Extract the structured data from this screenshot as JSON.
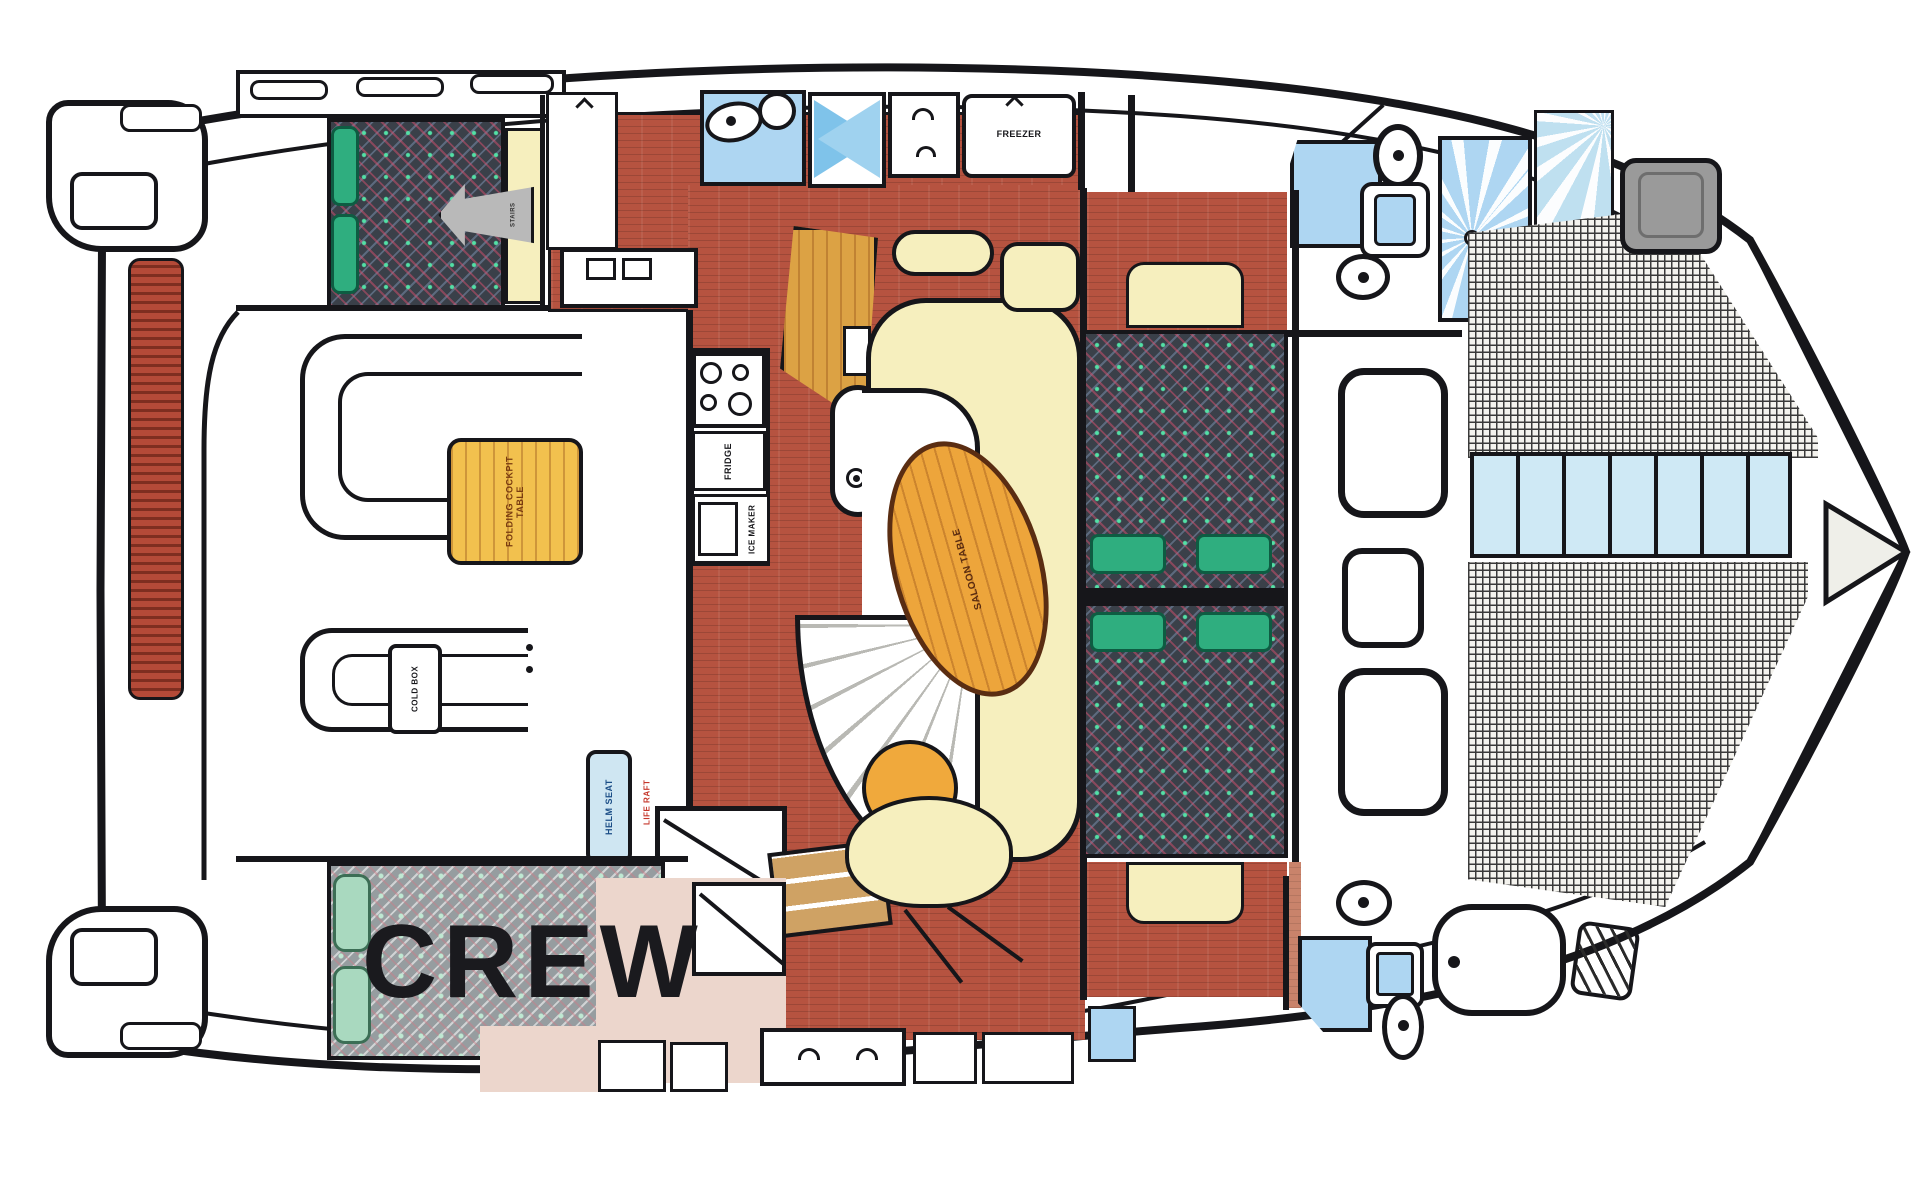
{
  "diagram_title": "Catamaran interior layout floor plan",
  "labels": {
    "crew": "CREW",
    "freezer": "FREEZER",
    "fridge": "FRIDGE",
    "ice_maker": "ICE MAKER",
    "cold_box": "COLD BOX",
    "helm_seat": "HELM SEAT",
    "life_raft": "LIFE RAFT",
    "folding_cockpit_table": "FOLDING COCKPIT TABLE",
    "saloon_table": "SALOON TABLE",
    "stairs": "STAIRS"
  },
  "colors": {
    "hull_outline": "#16161a",
    "wood_floor": "#b65340",
    "saloon_table_wood": "#eda53b",
    "cockpit_table_wood": "#f2c14e",
    "sofa_cream": "#f6efbe",
    "cushion_green": "#2fae7f",
    "cushion_mint": "#a9d9bf",
    "mattress_dark": "#3a4049",
    "water_blue": "#aed6f2",
    "cockpit_floor_pink": "#ecd6cc",
    "stern_plank_red": "#b44a38",
    "label_red": "#c5372b",
    "label_blue": "#1b4d86"
  },
  "icons": {
    "stove": "four-burner-circles",
    "sink": "oval-basin-with-dot",
    "toilet": "oval-bowl-with-tank",
    "shower": "rayed-blue-square",
    "shower_door": "blue-bowtie-cross",
    "vent": "chevron-arrow",
    "deck_hatch": "rounded-square",
    "trampoline": "mesh-grid",
    "stairs": "grey-step-arrow",
    "bathtub": "rounded-tub"
  }
}
